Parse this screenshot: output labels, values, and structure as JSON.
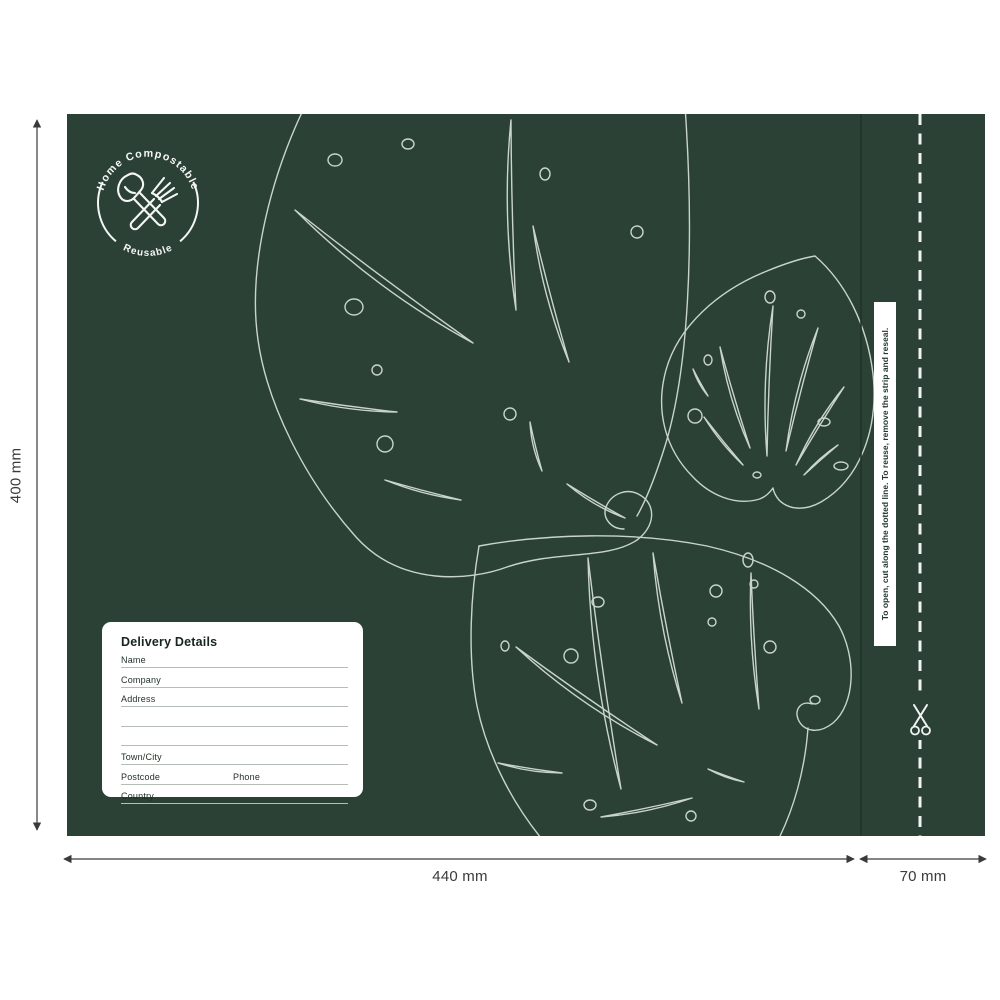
{
  "artboard": {
    "bag_color": "#2b4136",
    "leaf_line_color": "#c9d4cc",
    "accent_white": "#ffffff"
  },
  "badge": {
    "arc_top": "Home Compostable",
    "arc_bottom": "Reusable",
    "icons": [
      "trowel-icon",
      "fork-icon"
    ]
  },
  "delivery_label": {
    "title": "Delivery Details",
    "name": "Name",
    "company": "Company",
    "address": "Address",
    "town_city": "Town/City",
    "postcode": "Postcode",
    "phone": "Phone",
    "country": "Country"
  },
  "resealable_strip": {
    "instruction": "To open, cut along the dotted line. To reuse, remove the strip and reseal.",
    "icon": "scissors-icon"
  },
  "dimensions": {
    "height": "400 mm",
    "width_main": "440 mm",
    "width_strip": "70 mm"
  }
}
